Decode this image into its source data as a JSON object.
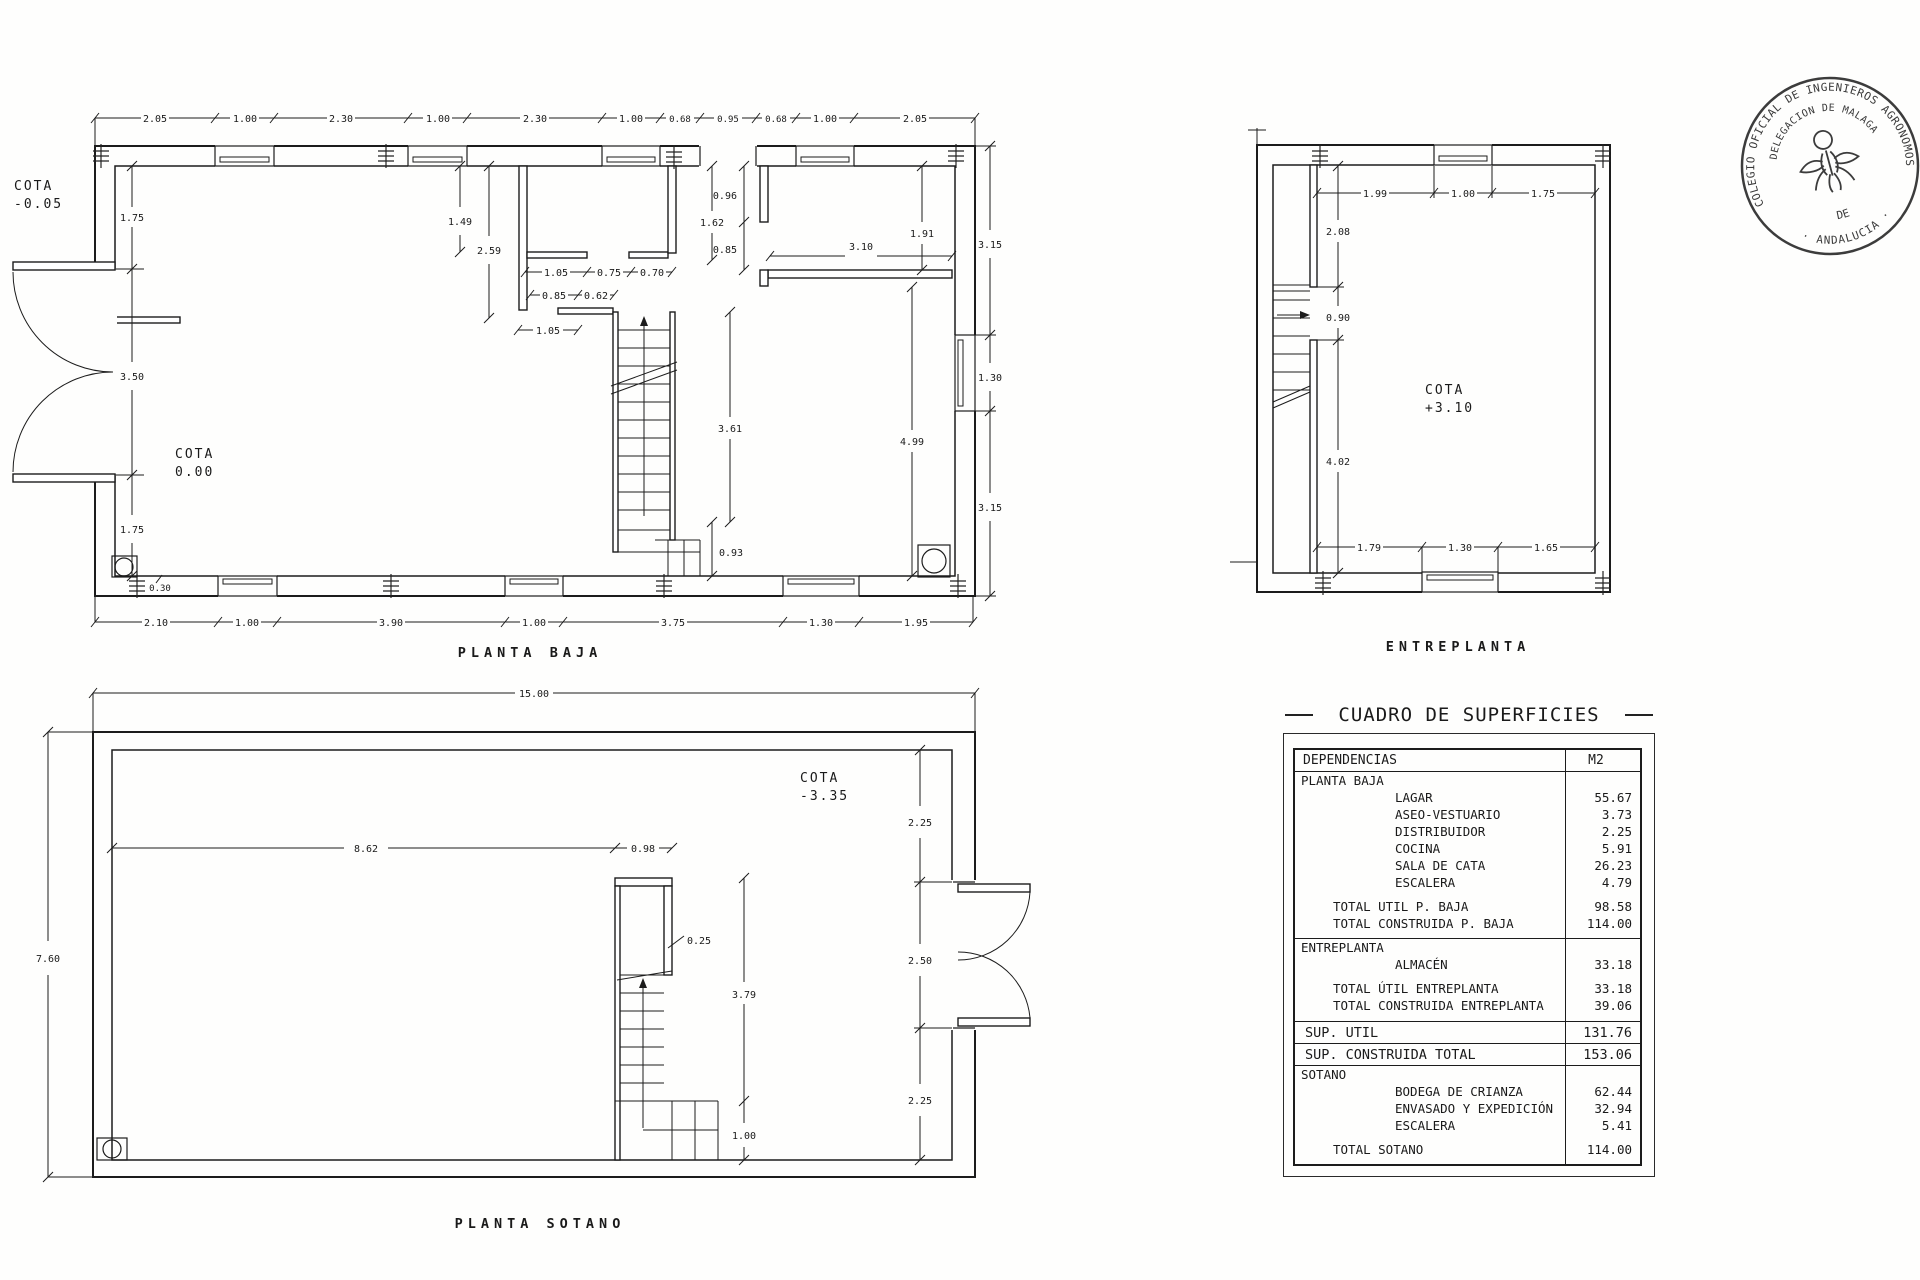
{
  "drawing": {
    "planta_baja": {
      "title": "PLANTA BAJA",
      "cota_exterior_l1": "COTA",
      "cota_exterior_l2": "-0.05",
      "cota_interior_l1": "COTA",
      "cota_interior_l2": "0.00",
      "top_dims": [
        "2.05",
        "1.00",
        "2.30",
        "1.00",
        "2.30",
        "1.00",
        "0.68",
        "0.95",
        "0.68",
        "1.00",
        "2.05"
      ],
      "bottom_dims": [
        "2.10",
        "1.00",
        "3.90",
        "1.00",
        "3.75",
        "1.30",
        "1.95"
      ],
      "left_dims": [
        "1.75",
        "3.50",
        "1.75"
      ],
      "right_dims": [
        "3.15",
        "1.30",
        "3.15"
      ],
      "interior": {
        "room_a": "1.49",
        "room_b": "2.59",
        "pass_a": "1.05",
        "door_a": "0.75",
        "door_b": "0.70",
        "door_c": "0.85",
        "door_d": "0.62",
        "pass_b": "1.05",
        "wall_a": "1.62",
        "vest_a": "0.96",
        "vest_b": "0.85",
        "sala_top": "3.10",
        "sala_right": "1.91",
        "stair": "3.61",
        "sala_height": "4.99",
        "stair_end": "0.93",
        "wall_th": "0.30"
      }
    },
    "entreplanta": {
      "title": "ENTREPLANTA",
      "cota_l1": "COTA",
      "cota_l2": "+3.10",
      "top_dims": [
        "1.99",
        "1.00",
        "1.75"
      ],
      "left_dims": [
        "2.08",
        "0.90",
        "4.02"
      ],
      "bottom_dims": [
        "1.79",
        "1.30",
        "1.65"
      ]
    },
    "sotano": {
      "title": "PLANTA SOTANO",
      "cota_l1": "COTA",
      "cota_l2": "-3.35",
      "overall_width": "15.00",
      "overall_height": "7.60",
      "right_dims": [
        "2.25",
        "2.50",
        "2.25"
      ],
      "interior": {
        "span": "8.62",
        "stair_w": "0.98",
        "wall": "0.25",
        "stair_len": "3.79",
        "landing": "1.00"
      }
    }
  },
  "stamp": {
    "outer_top": "COLEGIO OFICIAL DE INGENIEROS AGRONOMOS",
    "outer_bottom": "· ANDALUCIA ·",
    "inner_top": "DELEGACION DE MALAGA",
    "inner_bottom": "DE"
  },
  "table": {
    "title": "CUADRO DE SUPERFICIES",
    "header": {
      "left": "DEPENDENCIAS",
      "right": "M2"
    },
    "rows": [
      {
        "label": "PLANTA BAJA",
        "value": ""
      },
      {
        "label": "LAGAR",
        "value": "55.67"
      },
      {
        "label": "ASEO-VESTUARIO",
        "value": "3.73"
      },
      {
        "label": "DISTRIBUIDOR",
        "value": "2.25"
      },
      {
        "label": "COCINA",
        "value": "5.91"
      },
      {
        "label": "SALA DE CATA",
        "value": "26.23"
      },
      {
        "label": "ESCALERA",
        "value": "4.79"
      },
      {
        "label": "TOTAL UTIL P. BAJA",
        "value": "98.58"
      },
      {
        "label": "TOTAL CONSTRUIDA P. BAJA",
        "value": "114.00"
      },
      {
        "label": "ENTREPLANTA",
        "value": ""
      },
      {
        "label": "ALMACÉN",
        "value": "33.18"
      },
      {
        "label": "TOTAL ÚTIL ENTREPLANTA",
        "value": "33.18"
      },
      {
        "label": "TOTAL CONSTRUIDA ENTREPLANTA",
        "value": "39.06"
      },
      {
        "label": "SUP. UTIL",
        "value": "131.76"
      },
      {
        "label": "SUP. CONSTRUIDA TOTAL",
        "value": "153.06"
      },
      {
        "label": "SOTANO",
        "value": ""
      },
      {
        "label": "BODEGA DE CRIANZA",
        "value": "62.44"
      },
      {
        "label": "ENVASADO Y EXPEDICIÓN",
        "value": "32.94"
      },
      {
        "label": "ESCALERA",
        "value": "5.41"
      },
      {
        "label": "TOTAL SOTANO",
        "value": "114.00"
      }
    ]
  }
}
